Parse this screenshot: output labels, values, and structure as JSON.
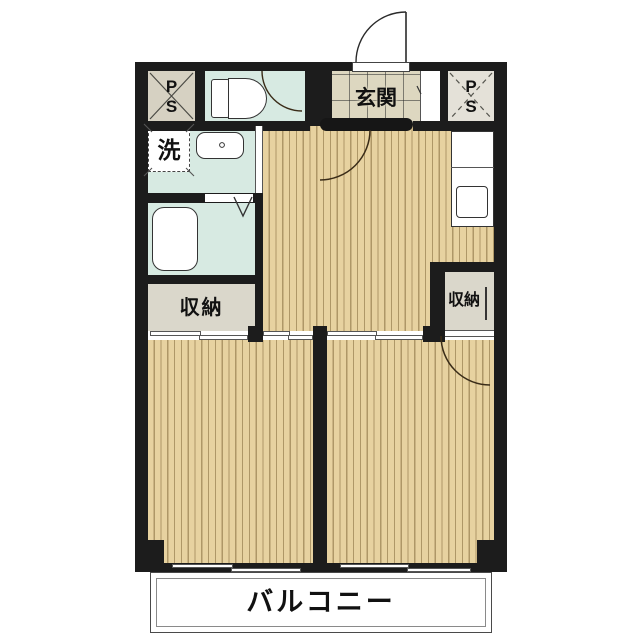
{
  "floorplan": {
    "labels": {
      "ps_left": {
        "line1": "P",
        "line2": "S"
      },
      "ps_right": {
        "line1": "P",
        "line2": "S"
      },
      "entrance": "玄関",
      "laundry": "洗",
      "storage_left": "収納",
      "storage_right": "収納",
      "balcony": "バルコニー"
    },
    "colors": {
      "wall": "#1c1c1c",
      "wood_floor": "#e7d2a0",
      "wood_stripe": "#765c2e",
      "wet_area": "#d7eae2",
      "entrance_tile": "#ddd7c0",
      "storage_fill": "#dad7cb",
      "ps_fill": "#d6d1c2"
    }
  }
}
